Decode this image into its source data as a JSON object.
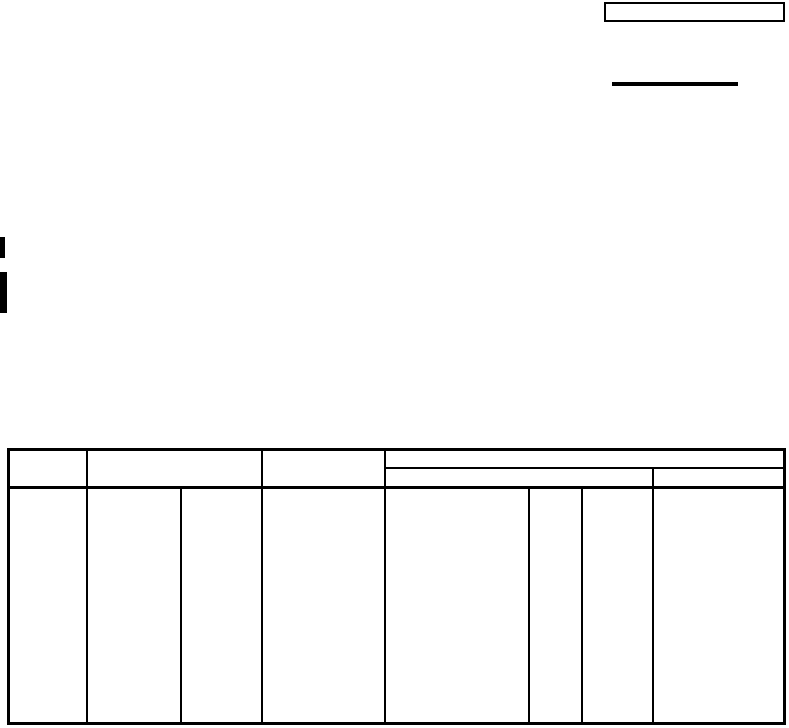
{
  "page": {
    "paper_color": "#ffffff",
    "ink_color": "#000000"
  },
  "header_area": {
    "top_right_entry_box": {
      "value": ""
    },
    "rule_line": {
      "value": ""
    }
  },
  "scan_artifacts": {
    "edge_mark_top": "",
    "edge_mark_bottom": ""
  },
  "form_table": {
    "header": {
      "col_a": "",
      "col_b": "",
      "col_c": "",
      "group_top": "",
      "group_sub_left": "",
      "group_sub_right": ""
    },
    "body_row": {
      "cells": [
        "",
        "",
        "",
        "",
        "",
        "",
        "",
        ""
      ]
    }
  }
}
